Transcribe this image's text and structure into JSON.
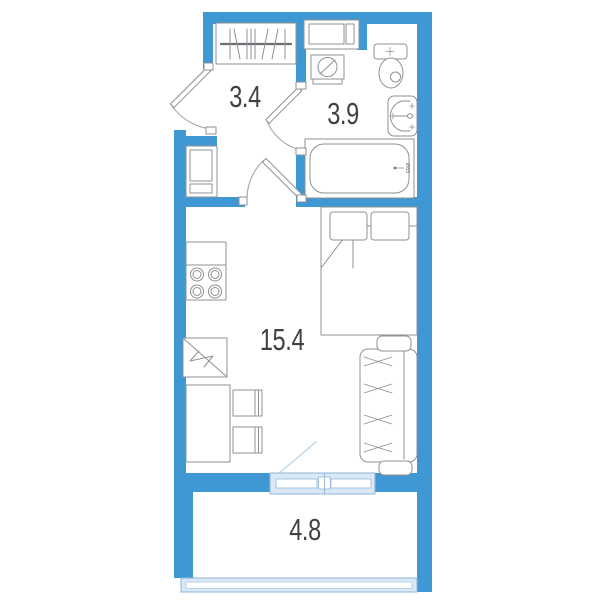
{
  "rooms": {
    "hall": {
      "area": "3.4"
    },
    "bathroom": {
      "area": "3.9",
      "drain_label": "Ø63"
    },
    "living_room": {
      "area": "15.4"
    },
    "balcony": {
      "area": "4.8"
    }
  },
  "colors": {
    "wall": "#3f97d3",
    "glazing_fill": "#dbe9f6",
    "glazing_border": "#8fb4d7",
    "swing_line": "#b9d4ea",
    "furniture_line": "#8e9296",
    "label_text": "#414141"
  },
  "legend": {
    "hall": [
      "entry-door",
      "wardrobe",
      "utility-shaft"
    ],
    "bathroom": [
      "storage-shelf",
      "washing-machine",
      "toilet",
      "washbasin",
      "bathtub",
      "bathroom-door"
    ],
    "living_room": [
      "kitchen-counter",
      "stove",
      "kitchen-sink-unit",
      "dining-table",
      "chair",
      "chair",
      "bed",
      "sofa",
      "room-door"
    ],
    "balcony": [
      "balcony-door-window",
      "balcony-glazing"
    ]
  }
}
